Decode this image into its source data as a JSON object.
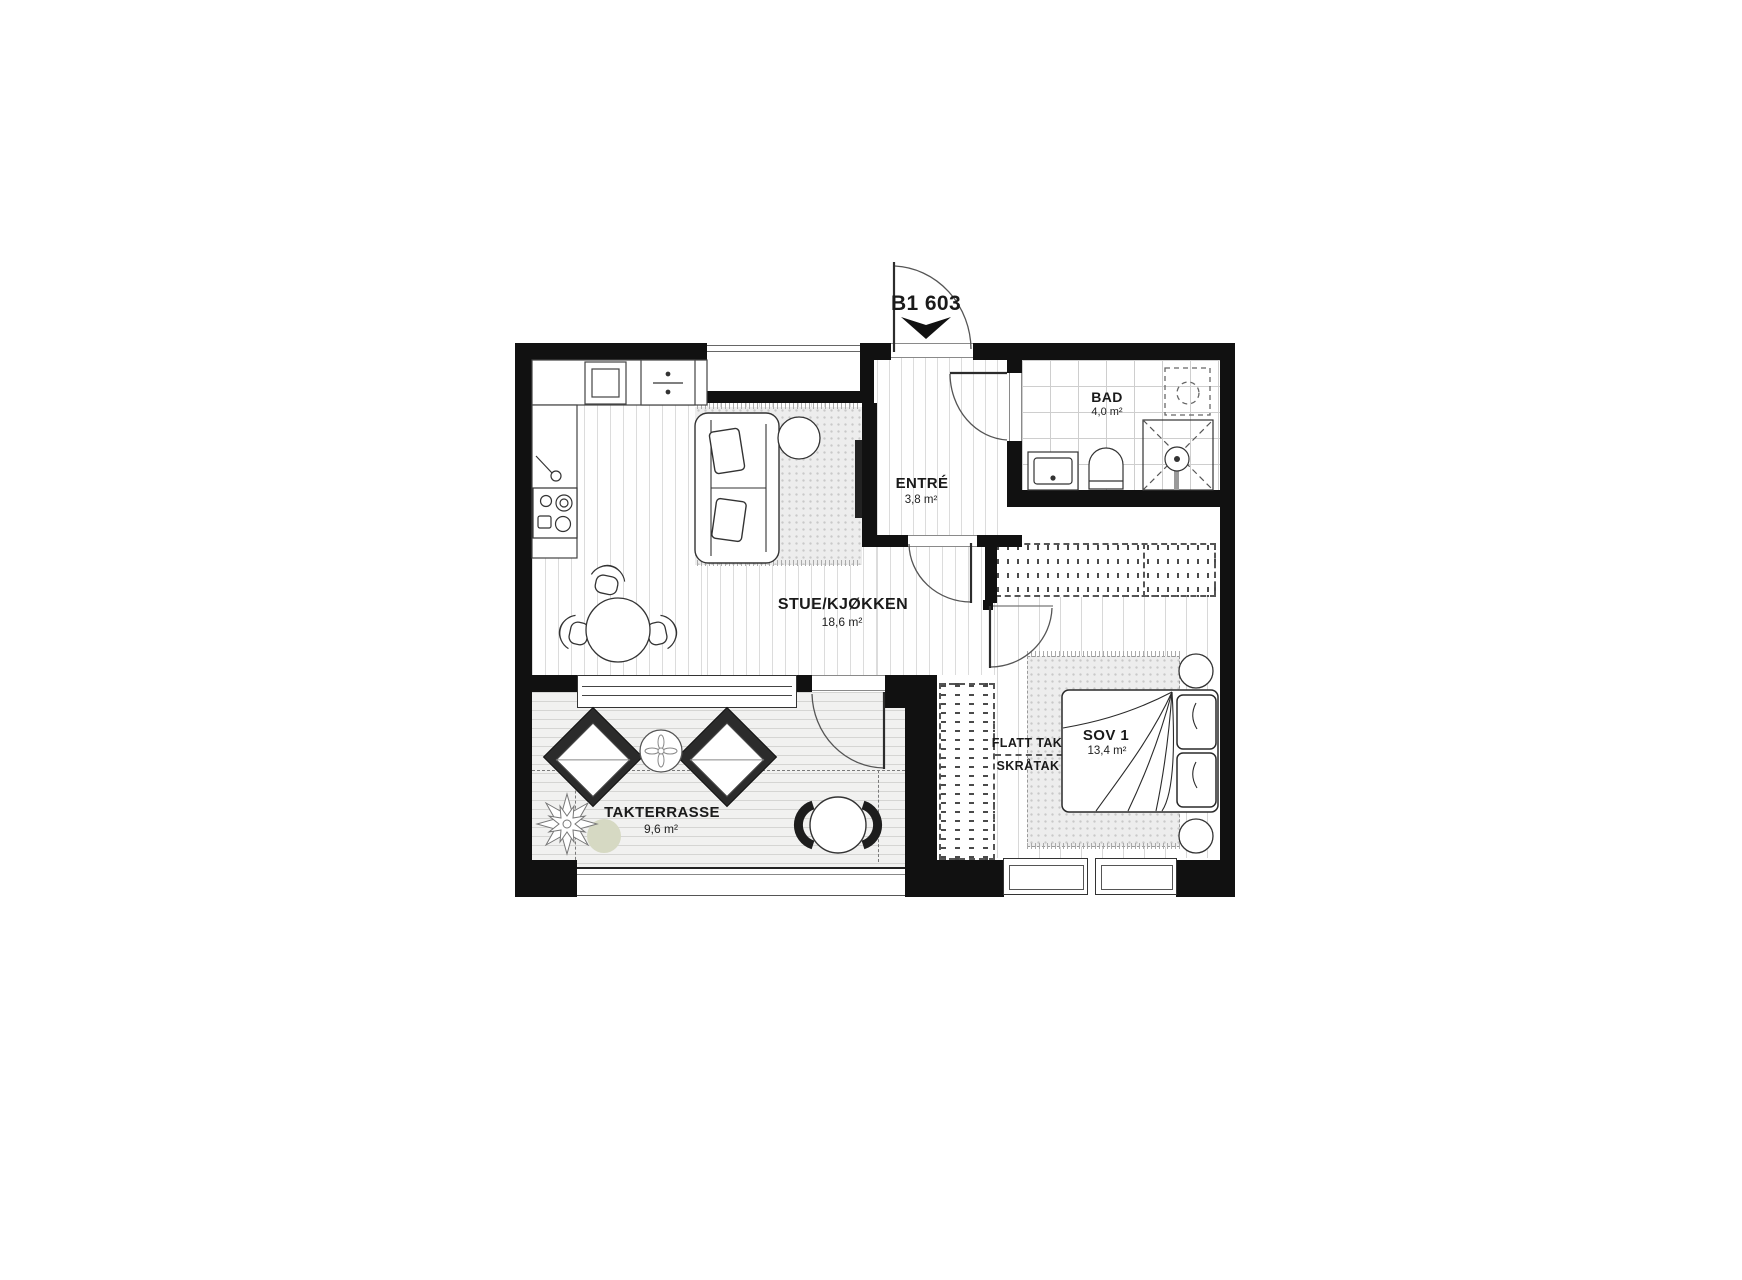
{
  "plan": {
    "unit_label": "B1 603",
    "rooms": {
      "bad": {
        "name": "BAD",
        "area": "4,0 m²"
      },
      "entre": {
        "name": "ENTRÉ",
        "area": "3,8 m²"
      },
      "stue": {
        "name": "STUE/KJØKKEN",
        "area": "18,6 m²"
      },
      "sov1": {
        "name": "SOV 1",
        "area": "13,4 m²"
      },
      "terrasse": {
        "name": "TAKTERRASSE",
        "area": "9,6 m²"
      }
    },
    "roof_labels": {
      "flat": "FLATT TAK",
      "sloped": "SKRÅTAK"
    },
    "colors": {
      "wall": "#111111",
      "plant_accent": "#d6d9c3",
      "line": "#333333"
    }
  }
}
